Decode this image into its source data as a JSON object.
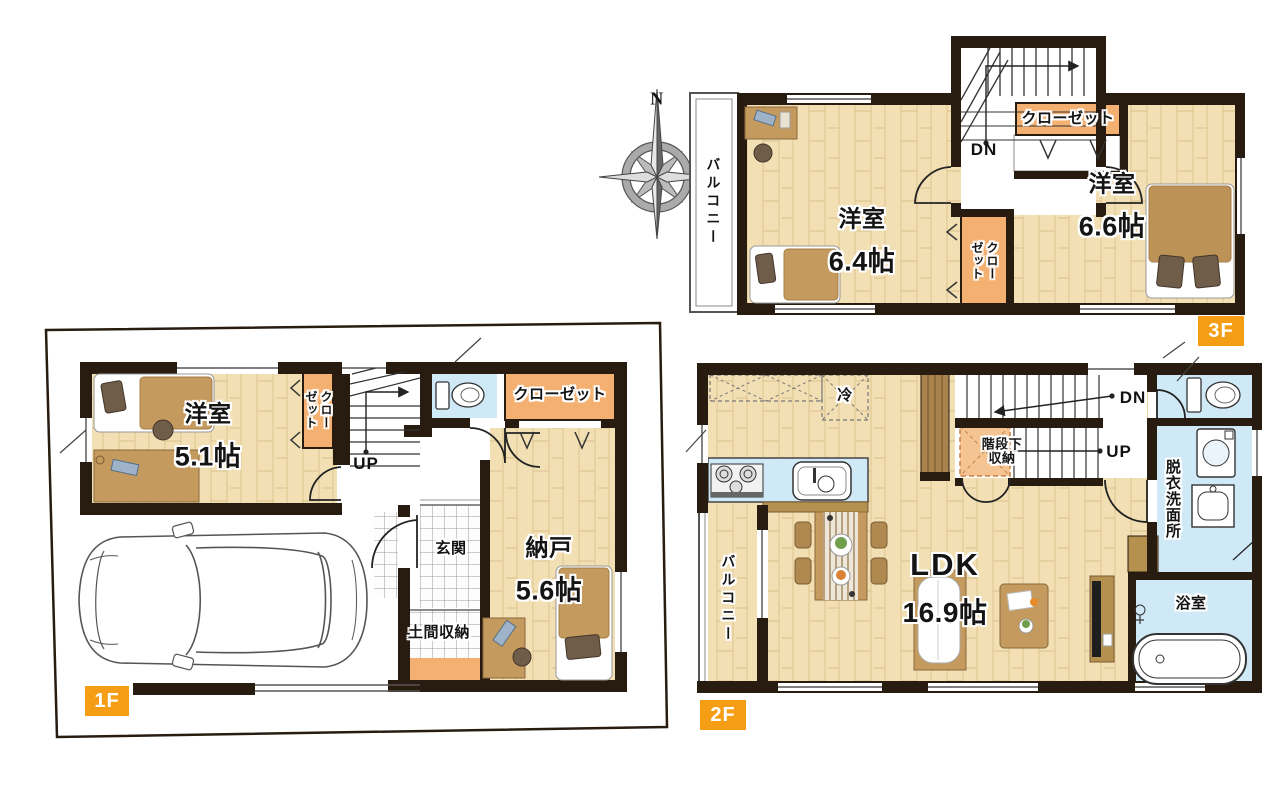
{
  "plan": {
    "compass": {
      "north_label": "N"
    },
    "floor1": {
      "badge": "1F",
      "bedroom_name": "洋室",
      "bedroom_size": "5.1帖",
      "closet_vertical": "クロー\nゼット",
      "closet": "クローゼット",
      "stair_up": "UP",
      "entrance": "玄関",
      "doma_storage": "土間収納",
      "storage_name": "納戸",
      "storage_size": "5.6帖"
    },
    "floor2": {
      "badge": "2F",
      "ldk_name": "LDK",
      "ldk_size": "16.9帖",
      "fridge": "冷",
      "understair_storage": "階段下\n収納",
      "stair_down": "DN",
      "stair_up": "UP",
      "washroom": "脱衣洗面所",
      "bath": "浴室",
      "balcony": "バルコニー"
    },
    "floor3": {
      "badge": "3F",
      "bedroom_left_name": "洋室",
      "bedroom_left_size": "6.4帖",
      "bedroom_right_name": "洋室",
      "bedroom_right_size": "6.6帖",
      "closet": "クローゼット",
      "closet_vertical": "クロー\nゼット",
      "stair_down": "DN",
      "balcony": "バルコニー"
    }
  },
  "colors": {
    "wall": "#281b10",
    "wood_floor": "#f2e0b4",
    "wet_area_blue": "#cfe9f6",
    "closet_orange": "#f4b071",
    "understair_orange": "#f5c493",
    "badge_orange": "#f59e15",
    "furniture_brown": "#c49a5e",
    "dark_brown": "#6f5c49"
  }
}
